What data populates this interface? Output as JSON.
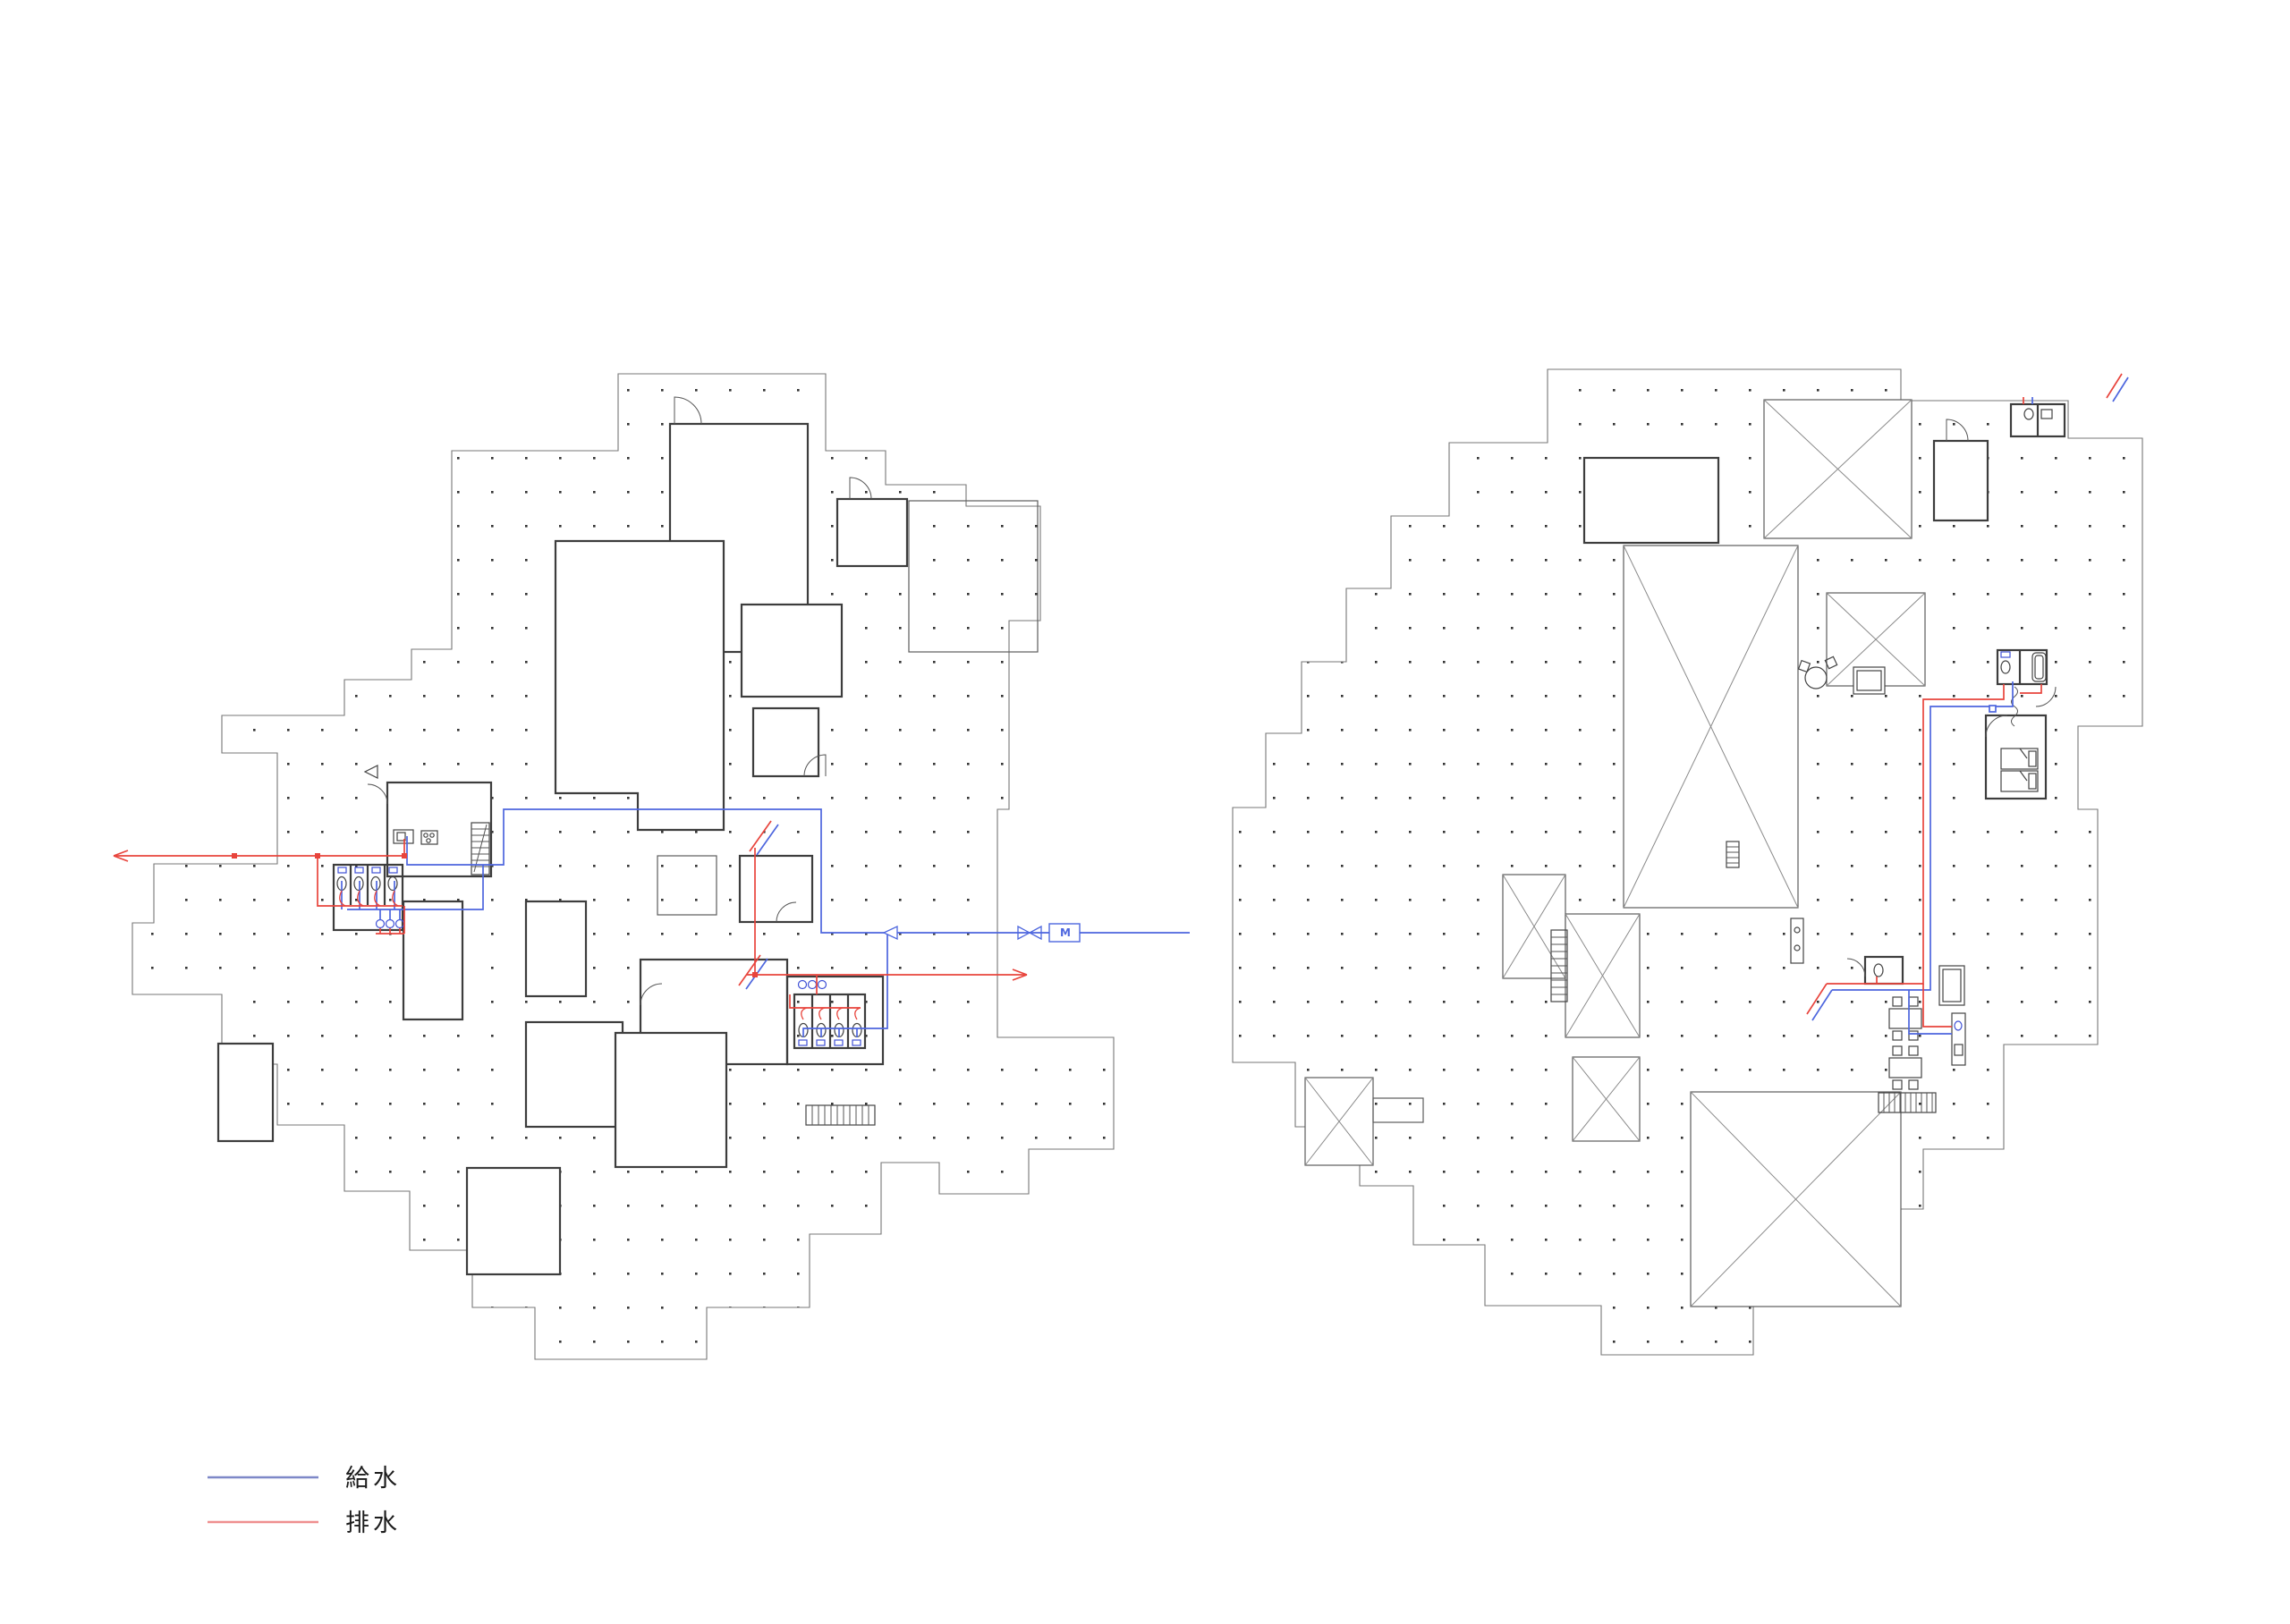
{
  "legend": {
    "items": [
      {
        "name": "supply-water",
        "label": "給水",
        "color": "#7e88c8"
      },
      {
        "name": "drain-water",
        "label": "排水",
        "color": "#ef8f8f"
      }
    ]
  },
  "meter": {
    "label": "M"
  },
  "colors": {
    "supply_pipe": "#4d66de",
    "drain_pipe": "#e8443c",
    "fixture_accent": "#3f51d6",
    "wall": "#3d3d3d",
    "outline": "#777777",
    "grid_dot": "#333333",
    "background": "#ffffff"
  }
}
